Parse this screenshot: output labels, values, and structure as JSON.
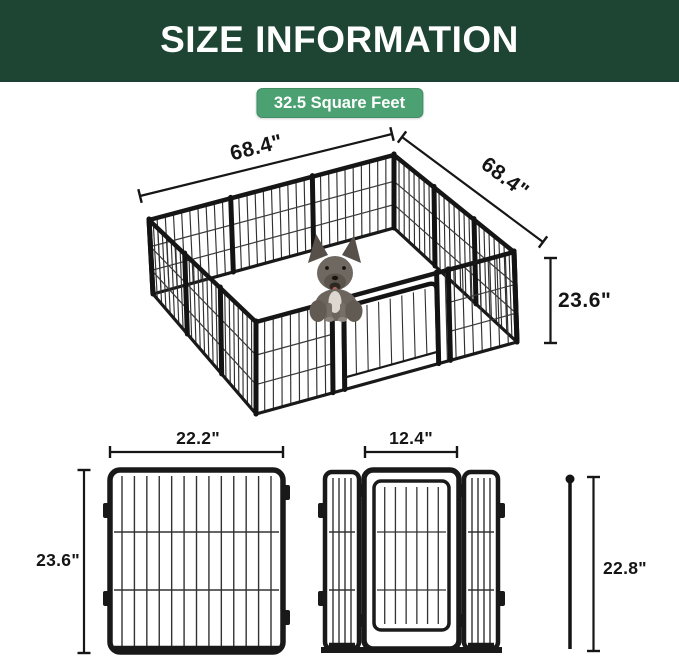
{
  "header": {
    "title": "SIZE INFORMATION"
  },
  "badge": {
    "text": "32.5 Square Feet"
  },
  "colors": {
    "header_bg": "#1e4434",
    "badge_bg": "#4ca173",
    "dim_line": "#161616",
    "metal": "#191919"
  },
  "pen": {
    "width_label": "68.4\"",
    "depth_label": "68.4\"",
    "height_label": "23.6\""
  },
  "panel_diagram": {
    "width_label": "22.2\"",
    "height_label": "23.6\""
  },
  "door_diagram": {
    "door_width_label": "12.4\"",
    "rod_height_label": "22.8\""
  }
}
